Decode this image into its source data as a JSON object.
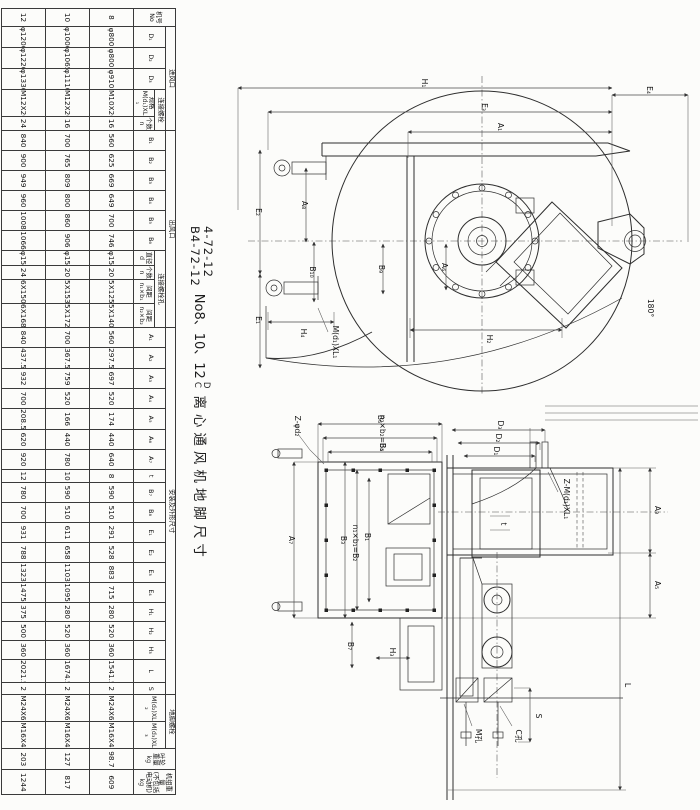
{
  "title": {
    "model_top": "4-72-12",
    "model_bottom": "B4-72-12",
    "size_text": "No8、10、12",
    "sup_top": "D",
    "sup_bottom": "C",
    "name": "离心通风机地脚尺寸"
  },
  "table": {
    "header_rows": [
      [
        {
          "t": "机号\nNo",
          "r": 3
        },
        {
          "t": "进风口",
          "c": 5
        },
        {
          "t": "出风口",
          "c": 10
        },
        {
          "t": "安装及外形尺寸",
          "c": 19
        },
        {
          "t": "地脚螺栓",
          "c": 2
        },
        {
          "t": "叶轮\n重量\nkg",
          "r": 3
        },
        {
          "t": "机组重量\n(不包括\n电动机)kg",
          "r": 3
        }
      ],
      [
        {
          "t": "D₁",
          "r": 2
        },
        {
          "t": "D₂",
          "r": 2
        },
        {
          "t": "D₃",
          "r": 2
        },
        {
          "t": "连接螺栓",
          "c": 2
        },
        {
          "t": "B₁",
          "r": 2
        },
        {
          "t": "B₂",
          "r": 2
        },
        {
          "t": "B₃",
          "r": 2
        },
        {
          "t": "B₄",
          "r": 2
        },
        {
          "t": "B₅",
          "r": 2
        },
        {
          "t": "B₆",
          "r": 2
        },
        {
          "t": "连接螺栓孔",
          "c": 4
        },
        {
          "t": "A₁",
          "r": 2
        },
        {
          "t": "A₂",
          "r": 2
        },
        {
          "t": "A₃",
          "r": 2
        },
        {
          "t": "A₄",
          "r": 2
        },
        {
          "t": "A₅",
          "r": 2
        },
        {
          "t": "A₆",
          "r": 2
        },
        {
          "t": "A₇",
          "r": 2
        },
        {
          "t": "t",
          "r": 2
        },
        {
          "t": "B₇",
          "r": 2
        },
        {
          "t": "B₈",
          "r": 2
        },
        {
          "t": "E₁",
          "r": 2
        },
        {
          "t": "E₂",
          "r": 2
        },
        {
          "t": "E₃",
          "r": 2
        },
        {
          "t": "E₄",
          "r": 2
        },
        {
          "t": "H₁",
          "r": 2
        },
        {
          "t": "H₂",
          "r": 2
        },
        {
          "t": "H₃",
          "r": 2
        },
        {
          "t": "L",
          "r": 2
        },
        {
          "t": "S",
          "r": 2
        },
        {
          "t": "M(d₂)XL₂",
          "r": 2
        },
        {
          "t": "M(d₃)XL₃",
          "r": 2
        }
      ],
      [
        {
          "t": "规格\nM(d₁)XL₁"
        },
        {
          "t": "个数\nn"
        },
        {
          "t": "直径\nd"
        },
        {
          "t": "个数\nn"
        },
        {
          "t": "间距\nn₁×b₁"
        },
        {
          "t": "间距\nn₂×b₂"
        }
      ]
    ],
    "rows": [
      [
        "8",
        "φ800",
        "φ800",
        "φ910",
        "M10X20",
        "16",
        "560",
        "625",
        "669",
        "649",
        "700",
        "746",
        "φ15",
        "20",
        "5X125",
        "5X140",
        "560",
        "297.5",
        "697",
        "520",
        "174",
        "440",
        "640",
        "8",
        "590",
        "510",
        "291",
        "528",
        "883",
        "715",
        "280",
        "520",
        "360",
        "1541.5",
        "2",
        "M24X630",
        "M16X400",
        "98.7",
        "609"
      ],
      [
        "10",
        "φ1000",
        "φ1065",
        "φ1110",
        "M12X20",
        "16",
        "700",
        "765",
        "809",
        "800",
        "860",
        "906",
        "φ15",
        "20",
        "5X153",
        "5X172",
        "700",
        "367.5",
        "759",
        "520",
        "166",
        "440",
        "780",
        "10",
        "590",
        "510",
        "611",
        "658",
        "1103",
        "1095",
        "280",
        "520",
        "360",
        "1674.5",
        "2",
        "M24X630",
        "M16X400",
        "127",
        "817"
      ],
      [
        "12",
        "φ1200",
        "φ1220",
        "φ1330",
        "M12X20",
        "24",
        "840",
        "900",
        "949",
        "960",
        "1008",
        "1066",
        "φ15",
        "24",
        "6X150",
        "6X168",
        "840",
        "437.5",
        "932",
        "700",
        "208.5",
        "620",
        "920",
        "12",
        "780",
        "700",
        "931",
        "788",
        "1323",
        "1475",
        "375",
        "500",
        "360",
        "2021.5",
        "2",
        "M24X630",
        "M16X400",
        "203",
        "1244"
      ]
    ]
  },
  "drawing_front": {
    "labels": {
      "H1": "H₁",
      "E4": "E₄",
      "E3": "E₃",
      "A1": "A₁",
      "E2": "E₂",
      "E1": "E₁",
      "A8": "A₈",
      "B10": "B₁₀",
      "B9": "B₉",
      "H4": "H₄",
      "Md1": "M(d₁)XL₁",
      "H2": "H₂",
      "A6": "A₆",
      "angle": "180°"
    }
  },
  "drawing_side": {
    "labels": {
      "B6": "B₆",
      "B5eq": "n₂×b₂=B₅",
      "B4": "B₄",
      "Zd2": "Z-φd₂",
      "A7": "A₇",
      "B3": "B₃",
      "B2eq": "n₁×b₁=B₂",
      "B1": "B₁",
      "B7": "B₇",
      "H3": "H₃",
      "D3": "D₃",
      "D2": "D₂",
      "D1": "D₁",
      "Zd1": "Z-M(d₁)XL₁",
      "t": "t",
      "A3": "A₃",
      "A5": "A₅",
      "L": "L",
      "S": "S",
      "callout_left": "M孔",
      "callout_right": "C孔"
    }
  }
}
